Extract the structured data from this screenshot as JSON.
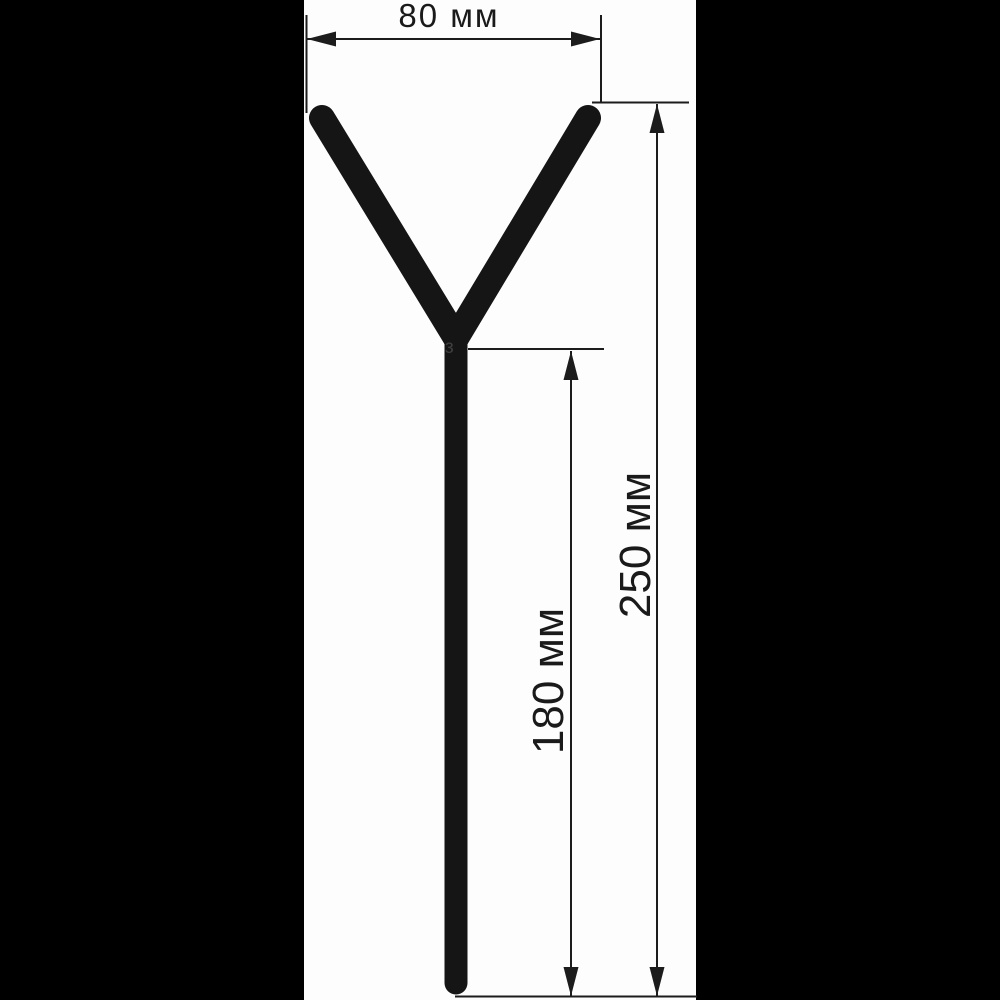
{
  "figure": {
    "name": "y-rod-stand",
    "kind": "technical-dimension-drawing",
    "dimensions": {
      "fork_width": {
        "value": 80,
        "unit": "мм",
        "label": "80 мм"
      },
      "total_height": {
        "value": 250,
        "unit": "мм",
        "label": "250 мм"
      },
      "stem_height": {
        "value": 180,
        "unit": "мм",
        "label": "180 мм"
      }
    },
    "weld_mark": "з"
  },
  "colors": {
    "letterbox": "#000000",
    "canvas": "#fdfdfd",
    "shape": "#151515",
    "dimension_lines": "#1c1c1c",
    "text": "#1a1a1a",
    "weld_mark": "#3f3f3f"
  }
}
